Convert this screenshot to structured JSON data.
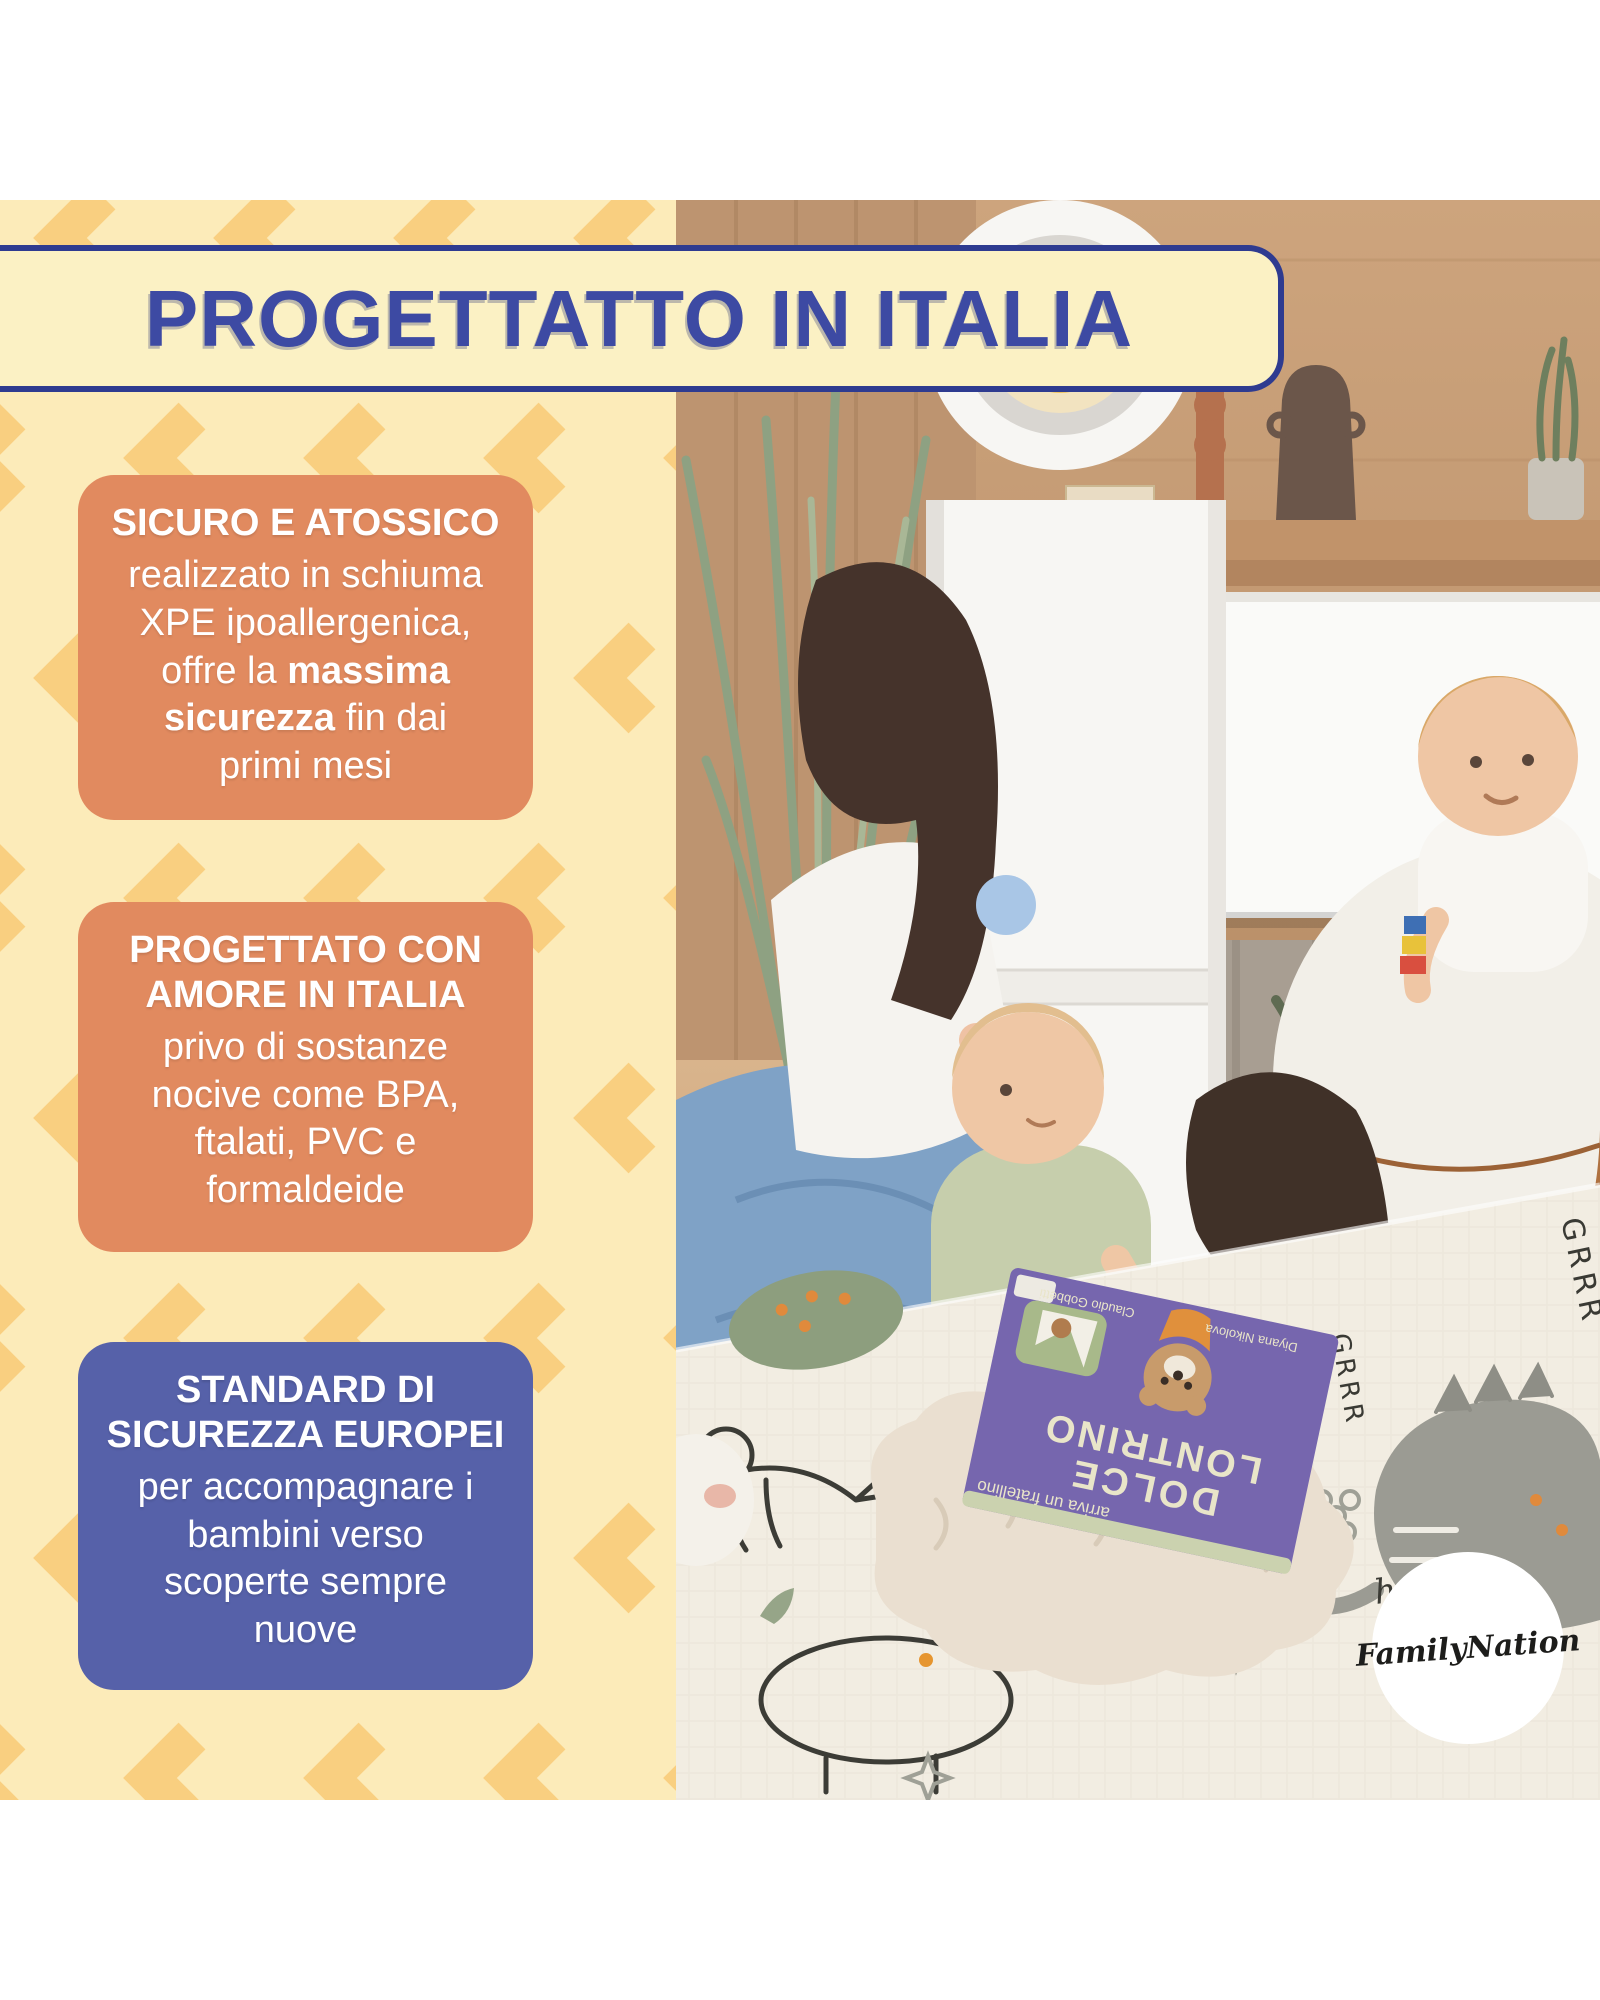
{
  "banner": {
    "title": "PROGETTATTO IN ITALIA"
  },
  "cards": [
    {
      "title": "SICURO E ATOSSICO",
      "body": "realizzato in schiuma\nXPE ipoallergenica,\noffre la **massima\nsicurezza** fin dai\nprimi mesi",
      "color": "#e18a5f"
    },
    {
      "title": "PROGETTATO CON\nAMORE IN ITALIA",
      "body": "privo di sostanze\nnocive come BPA,\nftalati, PVC e\nformaldeide",
      "color": "#e18a5f"
    },
    {
      "title": "STANDARD DI\nSICUREZZA EUROPEI",
      "body": "per accompagnare i\nbambini verso\nscoperte sempre\nnuove",
      "color": "#5661a9"
    }
  ],
  "photo": {
    "logo_text": "FamilyNation",
    "book": {
      "title1": "DOLCE",
      "title2": "LONTRINO",
      "subtitle": "arriva un fratellino",
      "author_left": "Claudio Gobbetti",
      "author_right": "Diyana Nikolova"
    },
    "mat_words": {
      "grrr": "GRRR",
      "hello": "hello",
      "hi": "Hi"
    }
  },
  "colors": {
    "panel_cream": "#fcebb9",
    "chevron_yellow": "#f9cf80",
    "banner_fill": "#fbf1c4",
    "banner_blue": "#3d4aa3",
    "banner_border": "#2e3b90",
    "card_orange": "#e18a5f",
    "card_blue": "#5661a9",
    "mat_cream": "#f2ede2",
    "book_purple": "#7666ae"
  }
}
